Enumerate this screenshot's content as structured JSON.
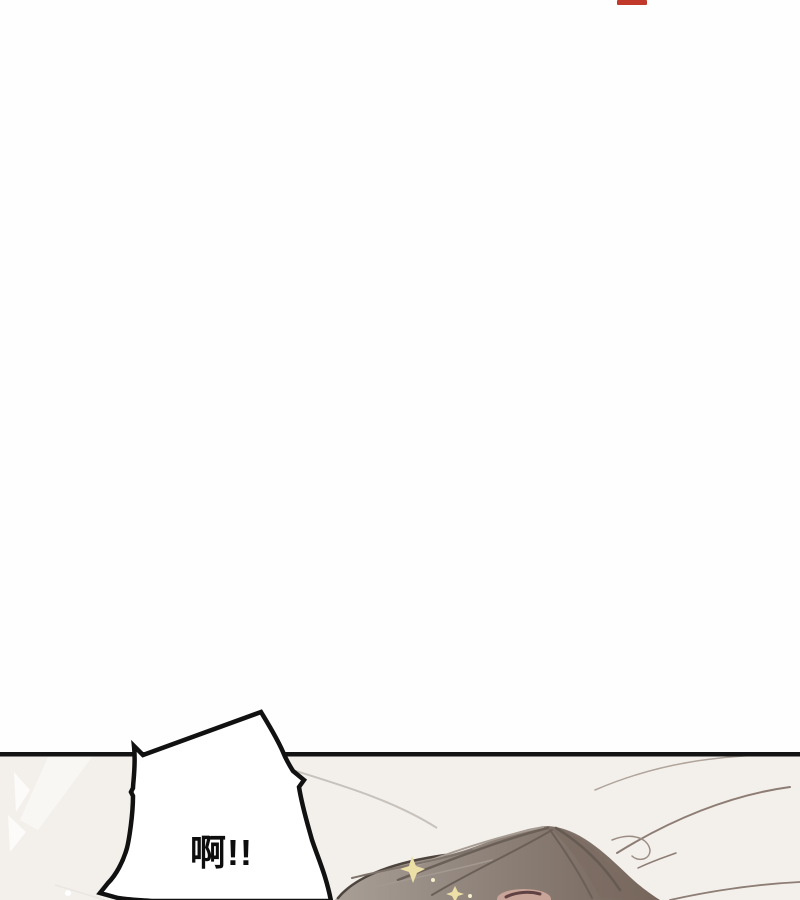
{
  "page": {
    "background_color": "#fefefe",
    "red_mark_color": "#c0392b"
  },
  "panel": {
    "background_color": "#f3f0ec",
    "border_color": "#141414"
  },
  "speech_bubble": {
    "text": "啊!!",
    "fill_color": "#ffffff",
    "outline_color": "#111111",
    "text_color": "#0d0d0d"
  },
  "artwork": {
    "hair_color_left": "#a89f97",
    "hair_color_right": "#75655b",
    "hair_strand_color": "#6b6058",
    "hair_edge_color": "#4d443e",
    "skin_color": "#c9a499",
    "brow_color": "#5f4241",
    "sparkle_color": "#ece0a6",
    "sheet_line_color": "#8d7d74",
    "pillow_line_color": "#c7c2bc"
  }
}
